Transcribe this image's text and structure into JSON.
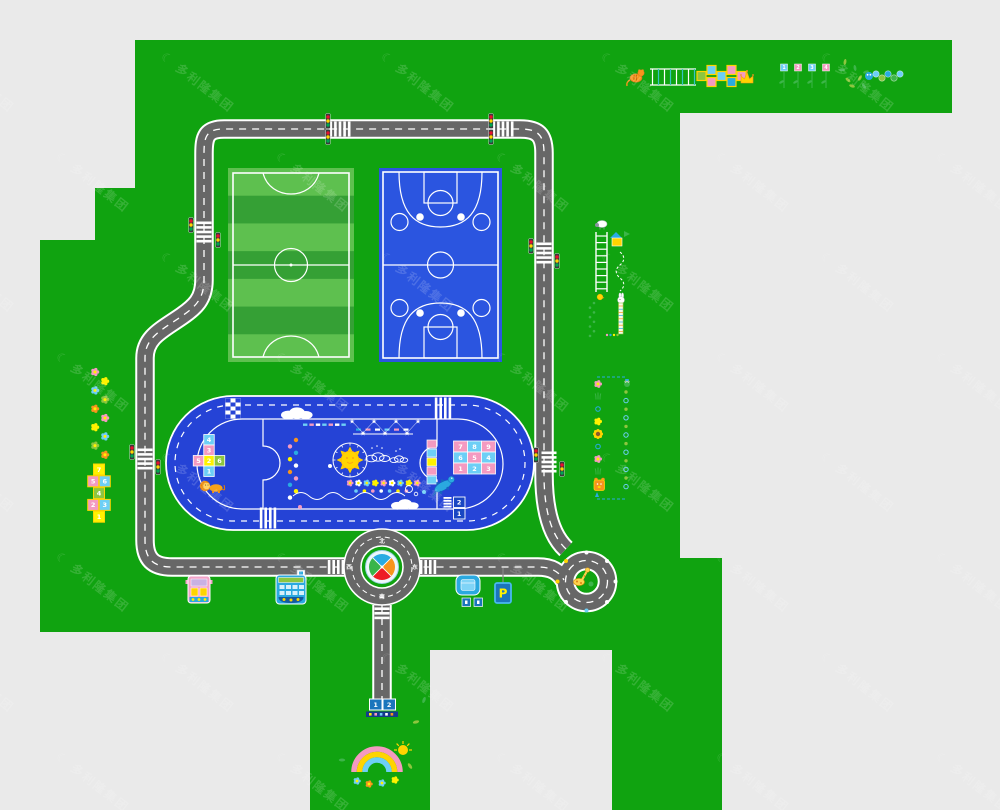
{
  "watermark": {
    "text": "多利隆集团",
    "logo_glyph": "☾",
    "logo_icon": "crescent-swoosh-logo"
  },
  "colors": {
    "canvas_bg": "#eaeaea",
    "grass": "#10a310",
    "road": "#676767",
    "road_line": "#ffffff",
    "soccer_light": "#5ec04f",
    "soccer_dark": "#35a035",
    "court_blue": "#2b55e0",
    "track_blue": "#2543d6",
    "sign_blue": "#1b75bc",
    "dark_sign_blue": "#163a8c",
    "accent_pink": "#f49ac1",
    "accent_cyan": "#6dcff6",
    "accent_yellow": "#fff200",
    "accent_green": "#8dc63f",
    "accent_blue": "#29abe2",
    "accent_orange": "#f7941d",
    "compass_red": "#ed1c24",
    "compass_green": "#39b54a",
    "traffic_red": "#e8112d",
    "traffic_yellow": "#ffd500",
    "traffic_green": "#00a650"
  },
  "roundabout": {
    "label_top": "北",
    "label_right": "东",
    "label_bottom": "南",
    "label_left": "西"
  },
  "parking": {
    "sign": "P"
  },
  "traffic_light": {
    "bulb_order": [
      "red",
      "yellow",
      "green"
    ]
  },
  "track_games": {
    "number_grid_rows": [
      [
        "7",
        "8",
        "9"
      ],
      [
        "6",
        "5",
        "4"
      ],
      [
        "1",
        "2",
        "3"
      ]
    ],
    "cross_hopscotch": {
      "column_top_to_bottom": [
        "4",
        "3",
        "2",
        "1"
      ],
      "left_arm": "5",
      "right_arm": "6"
    },
    "lane_numbers_top_to_bottom": [
      "2",
      "1"
    ],
    "figures": {
      "left": "lion",
      "right": "dragon"
    }
  },
  "south_road": {
    "start_numbers": [
      "1",
      "2"
    ]
  },
  "left_games": {
    "hopscotch_rows_top_to_bottom": [
      [
        "7"
      ],
      [
        "5",
        "6"
      ],
      [
        "4"
      ],
      [
        "2",
        "3"
      ],
      [
        "1"
      ]
    ]
  },
  "top_right_games": {
    "plant_numbers": [
      "1",
      "2",
      "3",
      "4"
    ],
    "figures": [
      "tiger",
      "ladder",
      "crown",
      "caterpillar-stones"
    ]
  },
  "right_games": {
    "figures": [
      "sheep",
      "ladder",
      "house",
      "rabbit",
      "ruler",
      "frog",
      "sunflower",
      "bear"
    ]
  },
  "bottom_games": {
    "figures": [
      "rainbow",
      "sun",
      "flowers"
    ]
  },
  "vehicles": {
    "figures": [
      "pink-bus",
      "blue-bus",
      "blue-car"
    ]
  }
}
